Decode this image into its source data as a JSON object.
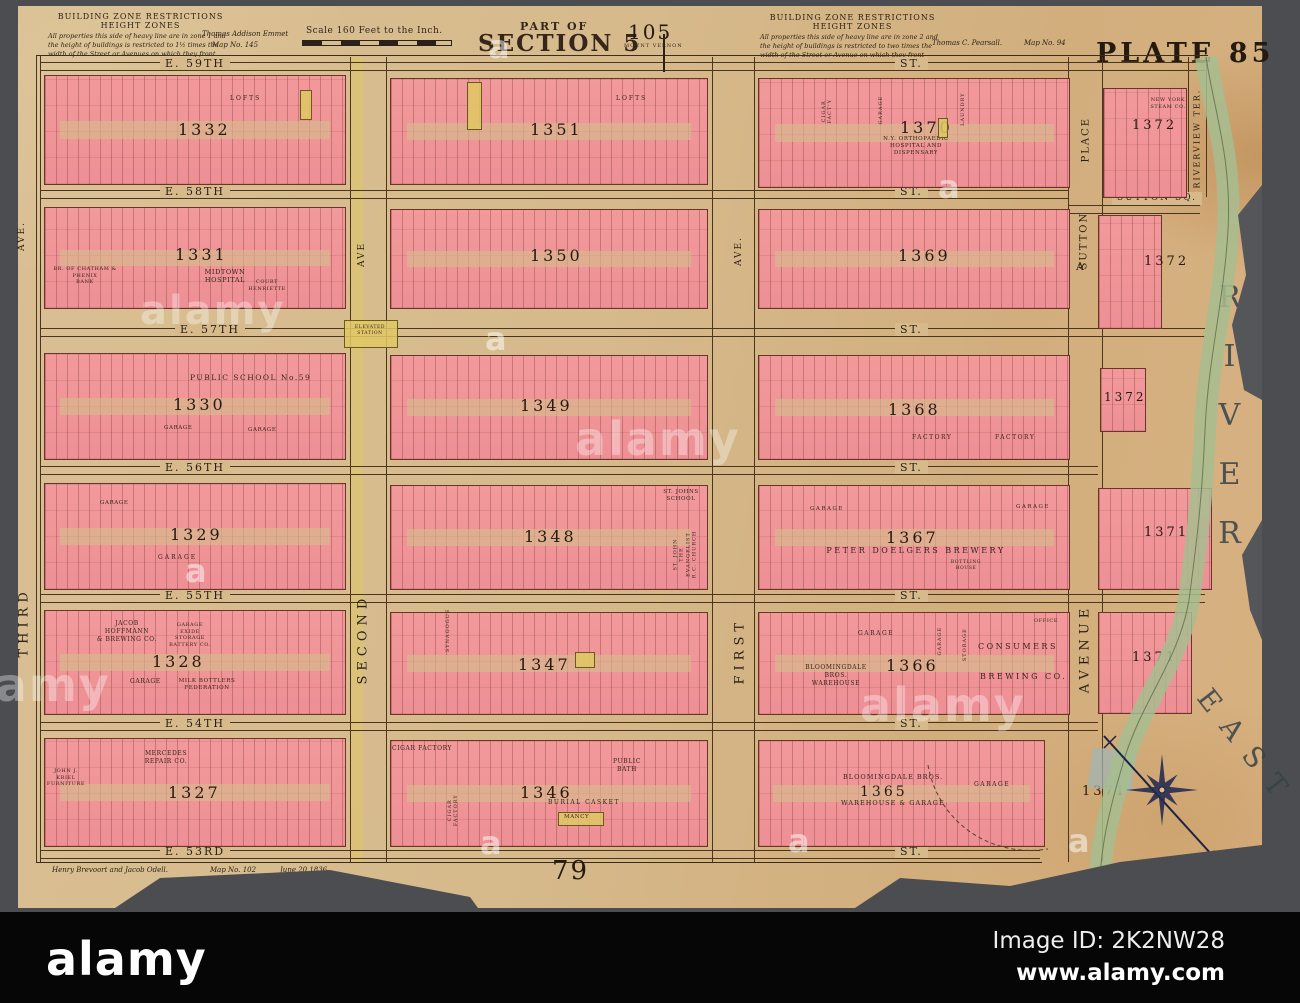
{
  "header": {
    "zone_left": {
      "title": "BUILDING ZONE RESTRICTIONS",
      "subtitle": "HEIGHT ZONES",
      "body": "All properties this side of heavy line are in zone 1 and the height of buildings is restricted to 1½ times the width of the Street or Avenues on which they front"
    },
    "owner_left": "Thomas Addison Emmet",
    "map_no_left": "Map No. 145",
    "scale": "Scale 160 Feet to the Inch.",
    "part_of": "PART OF",
    "section": "SECTION 5",
    "ref_no": "105",
    "mount_vernon": "MOUNT VERNON",
    "zone_right": {
      "title": "BUILDING ZONE RESTRICTIONS",
      "subtitle": "HEIGHT ZONES",
      "body": "All properties this side of heavy line are in zone 2 and the height of buildings is restricted to two times the width of the Street or Avenue on which they front"
    },
    "owner_right": "Thomas C. Pearsall.",
    "map_no_right": "Map No. 94",
    "plate": "PLATE 85"
  },
  "streets": {
    "s59": "E. 59TH",
    "s58": "E. 58TH",
    "s57": "E. 57TH",
    "s56": "E. 56TH",
    "s55": "E. 55TH",
    "s54": "E. 54TH",
    "s53": "E. 53RD",
    "suffix": "ST."
  },
  "avenues": {
    "third": "THIRD",
    "third_ave": "AVE.",
    "second": "SECOND",
    "second_ave": "AVE",
    "first": "FIRST",
    "first_ave": "AVE.",
    "avenue_a": "AVENUE",
    "a": "A",
    "sutton": "SUTTON",
    "place": "PLACE",
    "riverview": "RIVERVIEW TER.",
    "sutton_sq": "SUTTON SQ.",
    "elevated_station": "ELEVATED\nSTATION"
  },
  "river": {
    "east": "EAST",
    "river": "RIVER"
  },
  "blocks": {
    "b1332": {
      "number": "1332",
      "lofts": "LOFTS"
    },
    "b1351": {
      "number": "1351",
      "lofts": "LOFTS"
    },
    "b1370": {
      "number": "1370",
      "cigar": "CIGAR FACT'Y",
      "garage": "GARAGE",
      "laundry": "LAUNDRY",
      "hospital": "N.Y. ORTHOPAEDIC\nHOSPITAL AND\nDISPENSARY"
    },
    "b1372n": {
      "number": "1372",
      "steam": "NEW YORK\nSTEAM CO."
    },
    "b1331": {
      "number": "1331",
      "bank": "BR. OF CHATHAM & PHENIX\nBANK",
      "hospital": "MIDTOWN\nHOSPITAL",
      "court": "COURT\nHENRIETTE"
    },
    "b1350": {
      "number": "1350"
    },
    "b1369": {
      "number": "1369"
    },
    "b1372s": {
      "number": "1372"
    },
    "b1330": {
      "number": "1330",
      "school": "PUBLIC SCHOOL No.59",
      "garage1": "GARAGE",
      "garage2": "GARAGE"
    },
    "b1349": {
      "number": "1349"
    },
    "b1368": {
      "number": "1368",
      "factory1": "FACTORY",
      "factory2": "FACTORY"
    },
    "b1372sq": {
      "number": "1372"
    },
    "b1329": {
      "number": "1329",
      "garage1": "GARAGE",
      "garage2": "GARAGE"
    },
    "b1348": {
      "number": "1348",
      "school": "ST. JOHNS\nSCHOOL",
      "church": "ST. JOHN\nTHE EVANGELIST\nR.C. CHURCH"
    },
    "b1367": {
      "number": "1367",
      "garage1": "GARAGE",
      "garage2": "GARAGE",
      "brewery": "PETER DOELGERS BREWERY",
      "bottling": "BOTTLING\nHOUSE"
    },
    "b1371n": {
      "number": "1371"
    },
    "b1328": {
      "number": "1328",
      "brewing": "JACOB HOFFMANN\n& BREWING CO.",
      "exide": "GARAGE\nEXIDE STORAGE\nBATTERY CO.",
      "garage": "GARAGE",
      "milk": "MILK BOTTLERS\nFEDERATION"
    },
    "b1347": {
      "number": "1347",
      "synagogue": "SYNAGOGUE"
    },
    "b1366": {
      "number": "1366",
      "garage1": "GARAGE",
      "bloomingdale": "BLOOMINGDALE\nBROS.\nWAREHOUSE",
      "garage2": "GARAGE",
      "storage": "STORAGE",
      "consumers": "CONSUMERS",
      "brewing": "BREWING CO.",
      "office": "OFFICE"
    },
    "b1371m": {
      "number": "1371"
    },
    "b1327": {
      "number": "1327",
      "mercedes": "MERCEDES\nREPAIR CO.",
      "kriel": "JOHN J. KRIEL\nFURNITURE"
    },
    "b1346": {
      "number": "1346",
      "cigar1": "CIGAR FACTORY",
      "cigar2": "CIGAR\nFACTORY",
      "bath": "PUBLIC\nBATH",
      "casket": "BURIAL CASKET",
      "mancy": "MANCY"
    },
    "b1365": {
      "number": "1365",
      "bloomingdale1": "BLOOMINGDALE BROS.",
      "bloomingdale2": "WAREHOUSE & GARAGE",
      "garage": "GARAGE"
    },
    "b1371s": {
      "number": "1371"
    }
  },
  "map_footer": {
    "surveyors": "Henry Brevoort and Jacob Odell.",
    "map_no": "Map No. 102",
    "date": "June 20 1836",
    "adjacent_plate": "79"
  },
  "alamy": {
    "logo": "alamy",
    "image_id": "Image ID: 2K2NW28",
    "url": "www.alamy.com",
    "watermark": "alamy",
    "watermark_a": "a"
  }
}
